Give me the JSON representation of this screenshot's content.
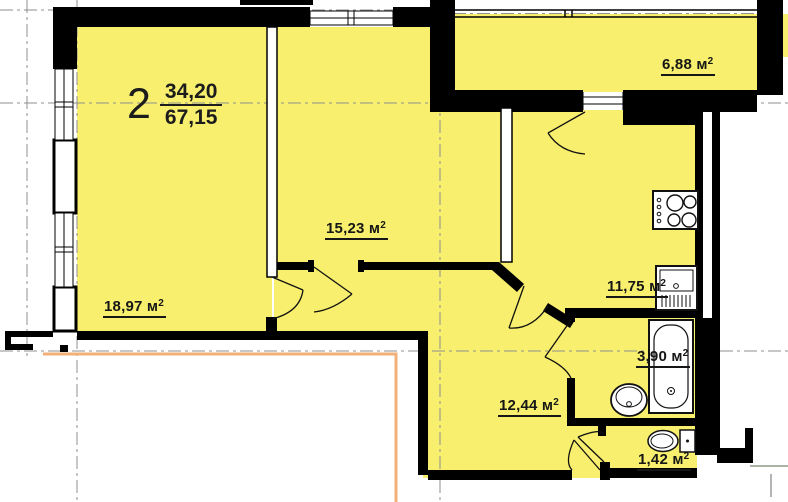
{
  "title_block": {
    "room_count": "2",
    "living_area": "34,20",
    "total_area": "67,15"
  },
  "area_unit": {
    "base": "м",
    "sup": "2"
  },
  "rooms": [
    {
      "name": "living-room",
      "area": "18,97"
    },
    {
      "name": "bedroom",
      "area": "15,23"
    },
    {
      "name": "kitchen",
      "area": "11,75"
    },
    {
      "name": "loggia",
      "area": "6,88"
    },
    {
      "name": "bathroom",
      "area": "3,90"
    },
    {
      "name": "hallway",
      "area": "12,44"
    },
    {
      "name": "wc",
      "area": "1,42"
    }
  ],
  "fixtures": [
    {
      "icon": "stove-icon"
    },
    {
      "icon": "kitchen-sink-icon"
    },
    {
      "icon": "bathtub-icon"
    },
    {
      "icon": "washbasin-icon"
    },
    {
      "icon": "toilet-icon"
    }
  ],
  "colors": {
    "room_fill": "#f7ef6d",
    "wall": "#000000",
    "centerline": "#8f8f8f",
    "accent_line": "#f0b078"
  }
}
